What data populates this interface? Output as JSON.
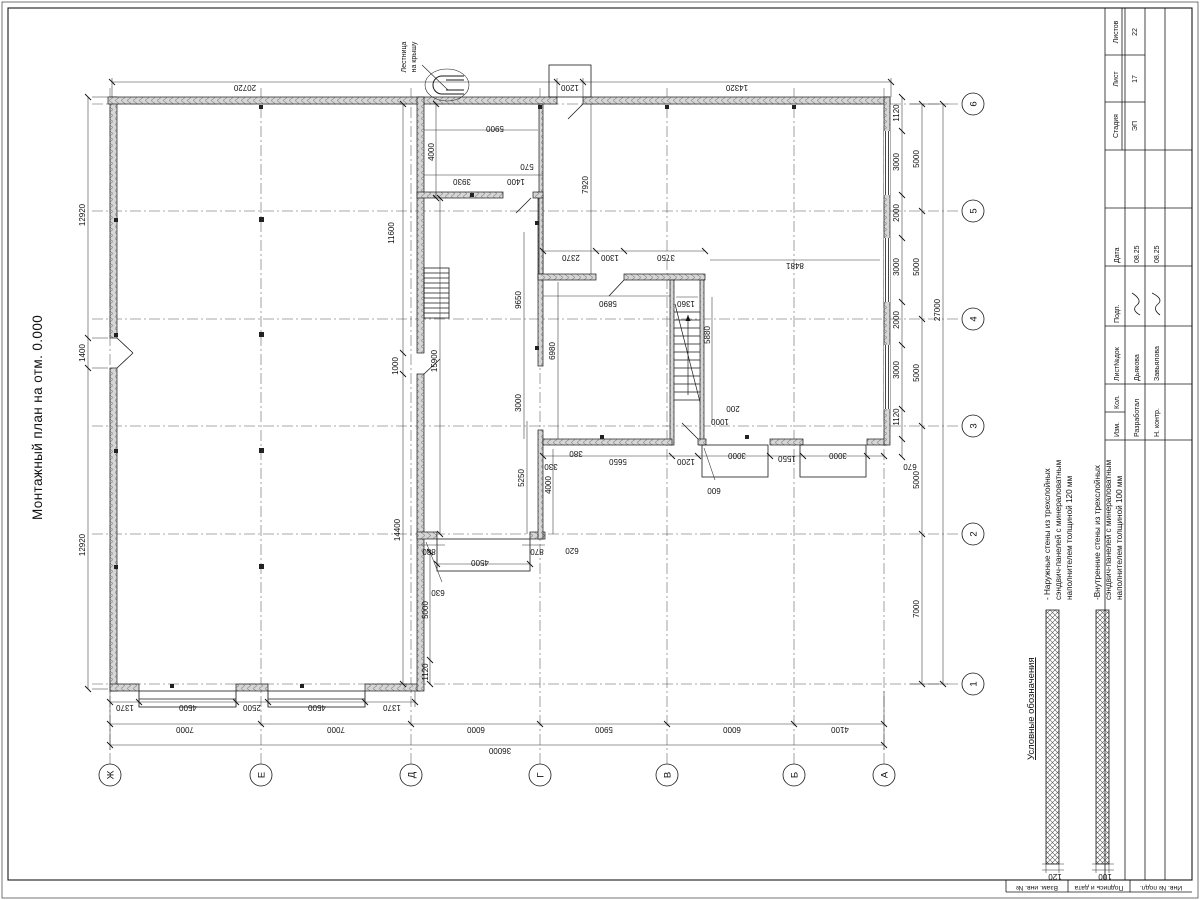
{
  "sheet": {
    "title": "Монтажный план на отм. 0.000"
  },
  "roof_ladder": {
    "line1": "Лестница",
    "line2": "на крышу"
  },
  "legend": {
    "title": "Условные обозначения",
    "items": [
      {
        "lines": [
          "- Наружные стены из трехслойных",
          "сэндвич-панелей с минераловатным",
          "наполнителем толщиной 120 мм"
        ],
        "thickness": "120"
      },
      {
        "lines": [
          "-Внутренние стены из трехслойных",
          "сэндвич-панелей с минераловатным",
          "наполнителем толщиной 100 мм"
        ],
        "thickness": "100"
      }
    ]
  },
  "axes": {
    "letters": [
      "Ж",
      "Е",
      "Д",
      "Г",
      "В",
      "Б",
      "А"
    ],
    "numbers": [
      "1",
      "2",
      "3",
      "4",
      "5",
      "6"
    ]
  },
  "stamp": {
    "header_cols": [
      "Изм.",
      "Кол.",
      "Лист№док",
      "Подп.",
      "Дата"
    ],
    "rows": [
      {
        "role": "Разработал",
        "name": "Дьякова",
        "date": "08.25"
      },
      {
        "role": "Н. контр.",
        "name": "Завьялова",
        "date": "08.25"
      }
    ],
    "stage_label": "Стадия",
    "sheet_label": "Лист",
    "sheets_label": "Листов",
    "stage": "ЭП",
    "sheet_no": "17",
    "sheets_total": "22"
  },
  "margin_fields": [
    "Взам. инв. №",
    "Подпись и дата",
    "Инв. № подл."
  ],
  "dims": [
    {
      "t": "12920",
      "x": 355,
      "y": 85,
      "r": "h"
    },
    {
      "t": "1400",
      "x": 547,
      "y": 85,
      "r": "h"
    },
    {
      "t": "12920",
      "x": 685,
      "y": 85,
      "r": "h"
    },
    {
      "t": "20720",
      "x": 815,
      "y": 245,
      "r": "v"
    },
    {
      "t": "1200",
      "x": 815,
      "y": 570,
      "r": "v"
    },
    {
      "t": "14320",
      "x": 815,
      "y": 737,
      "r": "v"
    },
    {
      "t": "1370",
      "x": 195,
      "y": 125,
      "r": "v"
    },
    {
      "t": "4500",
      "x": 195,
      "y": 188,
      "r": "v"
    },
    {
      "t": "2500",
      "x": 195,
      "y": 252,
      "r": "v"
    },
    {
      "t": "4500",
      "x": 195,
      "y": 317,
      "r": "v"
    },
    {
      "t": "1370",
      "x": 195,
      "y": 392,
      "r": "v"
    },
    {
      "t": "7000",
      "x": 173,
      "y": 185,
      "r": "v"
    },
    {
      "t": "7000",
      "x": 173,
      "y": 336,
      "r": "v"
    },
    {
      "t": "6000",
      "x": 173,
      "y": 476,
      "r": "v"
    },
    {
      "t": "5900",
      "x": 173,
      "y": 604,
      "r": "v"
    },
    {
      "t": "6000",
      "x": 173,
      "y": 732,
      "r": "v"
    },
    {
      "t": "4100",
      "x": 173,
      "y": 840,
      "r": "v"
    },
    {
      "t": "36000",
      "x": 152,
      "y": 500,
      "r": "v"
    },
    {
      "t": "670",
      "x": 436,
      "y": 910,
      "r": "v"
    },
    {
      "t": "1120",
      "x": 483,
      "y": 899,
      "r": "h"
    },
    {
      "t": "3000",
      "x": 530,
      "y": 899,
      "r": "h"
    },
    {
      "t": "2000",
      "x": 580,
      "y": 899,
      "r": "h"
    },
    {
      "t": "3000",
      "x": 633,
      "y": 899,
      "r": "h"
    },
    {
      "t": "2000",
      "x": 687,
      "y": 899,
      "r": "h"
    },
    {
      "t": "3000",
      "x": 738,
      "y": 899,
      "r": "h"
    },
    {
      "t": "1120",
      "x": 787,
      "y": 899,
      "r": "h"
    },
    {
      "t": "7000",
      "x": 291,
      "y": 919,
      "r": "h"
    },
    {
      "t": "5000",
      "x": 420,
      "y": 919,
      "r": "h"
    },
    {
      "t": "5000",
      "x": 527,
      "y": 919,
      "r": "h"
    },
    {
      "t": "5000",
      "x": 633,
      "y": 919,
      "r": "h"
    },
    {
      "t": "5000",
      "x": 741,
      "y": 919,
      "r": "h"
    },
    {
      "t": "27000",
      "x": 590,
      "y": 940,
      "r": "h"
    },
    {
      "t": "14400",
      "x": 370,
      "y": 400,
      "r": "h"
    },
    {
      "t": "1000",
      "x": 534,
      "y": 398,
      "r": "h"
    },
    {
      "t": "11600",
      "x": 667,
      "y": 394,
      "r": "h"
    },
    {
      "t": "15900",
      "x": 539,
      "y": 437,
      "r": "h"
    },
    {
      "t": "1120",
      "x": 228,
      "y": 428,
      "r": "h"
    },
    {
      "t": "5000",
      "x": 290,
      "y": 428,
      "r": "h"
    },
    {
      "t": "4000",
      "x": 748,
      "y": 434,
      "r": "h"
    },
    {
      "t": "5900",
      "x": 774,
      "y": 495,
      "r": "v"
    },
    {
      "t": "3930",
      "x": 721,
      "y": 462,
      "r": "v"
    },
    {
      "t": "1400",
      "x": 721,
      "y": 516,
      "r": "v"
    },
    {
      "t": "570",
      "x": 736,
      "y": 527,
      "r": "v"
    },
    {
      "t": "880",
      "x": 351,
      "y": 429,
      "r": "v"
    },
    {
      "t": "4500",
      "x": 340,
      "y": 480,
      "r": "v"
    },
    {
      "t": "870",
      "x": 351,
      "y": 537,
      "r": "v"
    },
    {
      "t": "630",
      "x": 310,
      "y": 438,
      "r": "v"
    },
    {
      "t": "5250",
      "x": 422,
      "y": 524,
      "r": "h"
    },
    {
      "t": "4000",
      "x": 415,
      "y": 551,
      "r": "h"
    },
    {
      "t": "620",
      "x": 352,
      "y": 572,
      "r": "v"
    },
    {
      "t": "3000",
      "x": 497,
      "y": 521,
      "r": "h"
    },
    {
      "t": "9650",
      "x": 600,
      "y": 521,
      "r": "h"
    },
    {
      "t": "6980",
      "x": 549,
      "y": 555,
      "r": "h"
    },
    {
      "t": "5890",
      "x": 599,
      "y": 608,
      "r": "v"
    },
    {
      "t": "2370",
      "x": 645,
      "y": 571,
      "r": "v"
    },
    {
      "t": "1300",
      "x": 645,
      "y": 610,
      "r": "v"
    },
    {
      "t": "3750",
      "x": 645,
      "y": 666,
      "r": "v"
    },
    {
      "t": "7920",
      "x": 715,
      "y": 588,
      "r": "h"
    },
    {
      "t": "8481",
      "x": 637,
      "y": 795,
      "r": "v"
    },
    {
      "t": "1360",
      "x": 599,
      "y": 686,
      "r": "v"
    },
    {
      "t": "5880",
      "x": 565,
      "y": 710,
      "r": "h"
    },
    {
      "t": "1000",
      "x": 481,
      "y": 720,
      "r": "v"
    },
    {
      "t": "200",
      "x": 494,
      "y": 733,
      "r": "v"
    },
    {
      "t": "600",
      "x": 412,
      "y": 714,
      "r": "v"
    },
    {
      "t": "330",
      "x": 436,
      "y": 551,
      "r": "v"
    },
    {
      "t": "380",
      "x": 449,
      "y": 576,
      "r": "v"
    },
    {
      "t": "5650",
      "x": 441,
      "y": 618,
      "r": "v"
    },
    {
      "t": "1200",
      "x": 441,
      "y": 686,
      "r": "v"
    },
    {
      "t": "3000",
      "x": 447,
      "y": 737,
      "r": "v"
    },
    {
      "t": "1550",
      "x": 444,
      "y": 787,
      "r": "v"
    },
    {
      "t": "3000",
      "x": 447,
      "y": 838,
      "r": "v"
    }
  ]
}
